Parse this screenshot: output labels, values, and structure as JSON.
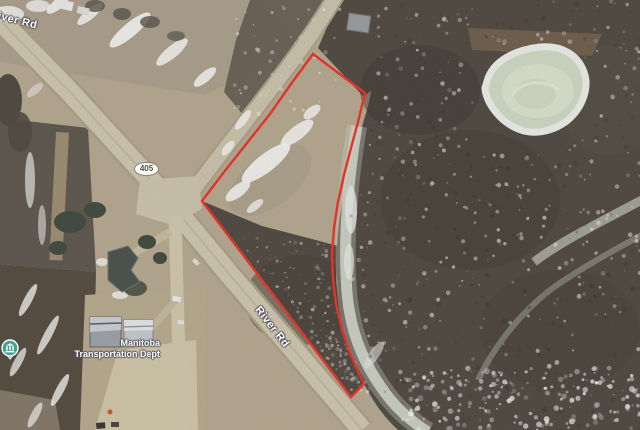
{
  "labels": {
    "river_rd_nw": "River Rd",
    "river_rd_se": "River Rd",
    "route_405": "405",
    "poi_line1": "Manitoba",
    "poi_line2": "Transportation Dept"
  },
  "icons": {
    "poi_pin": "government-building-icon",
    "route_shield": "oval-route-shield"
  },
  "colors": {
    "parcel_outline": "#e2342b",
    "poi_pin": "#43a093",
    "road_surface": "#cdc4ae",
    "woods": "#4c463e",
    "pond_ice": "#cdd6c3",
    "field_tan": "#b3a68e"
  }
}
